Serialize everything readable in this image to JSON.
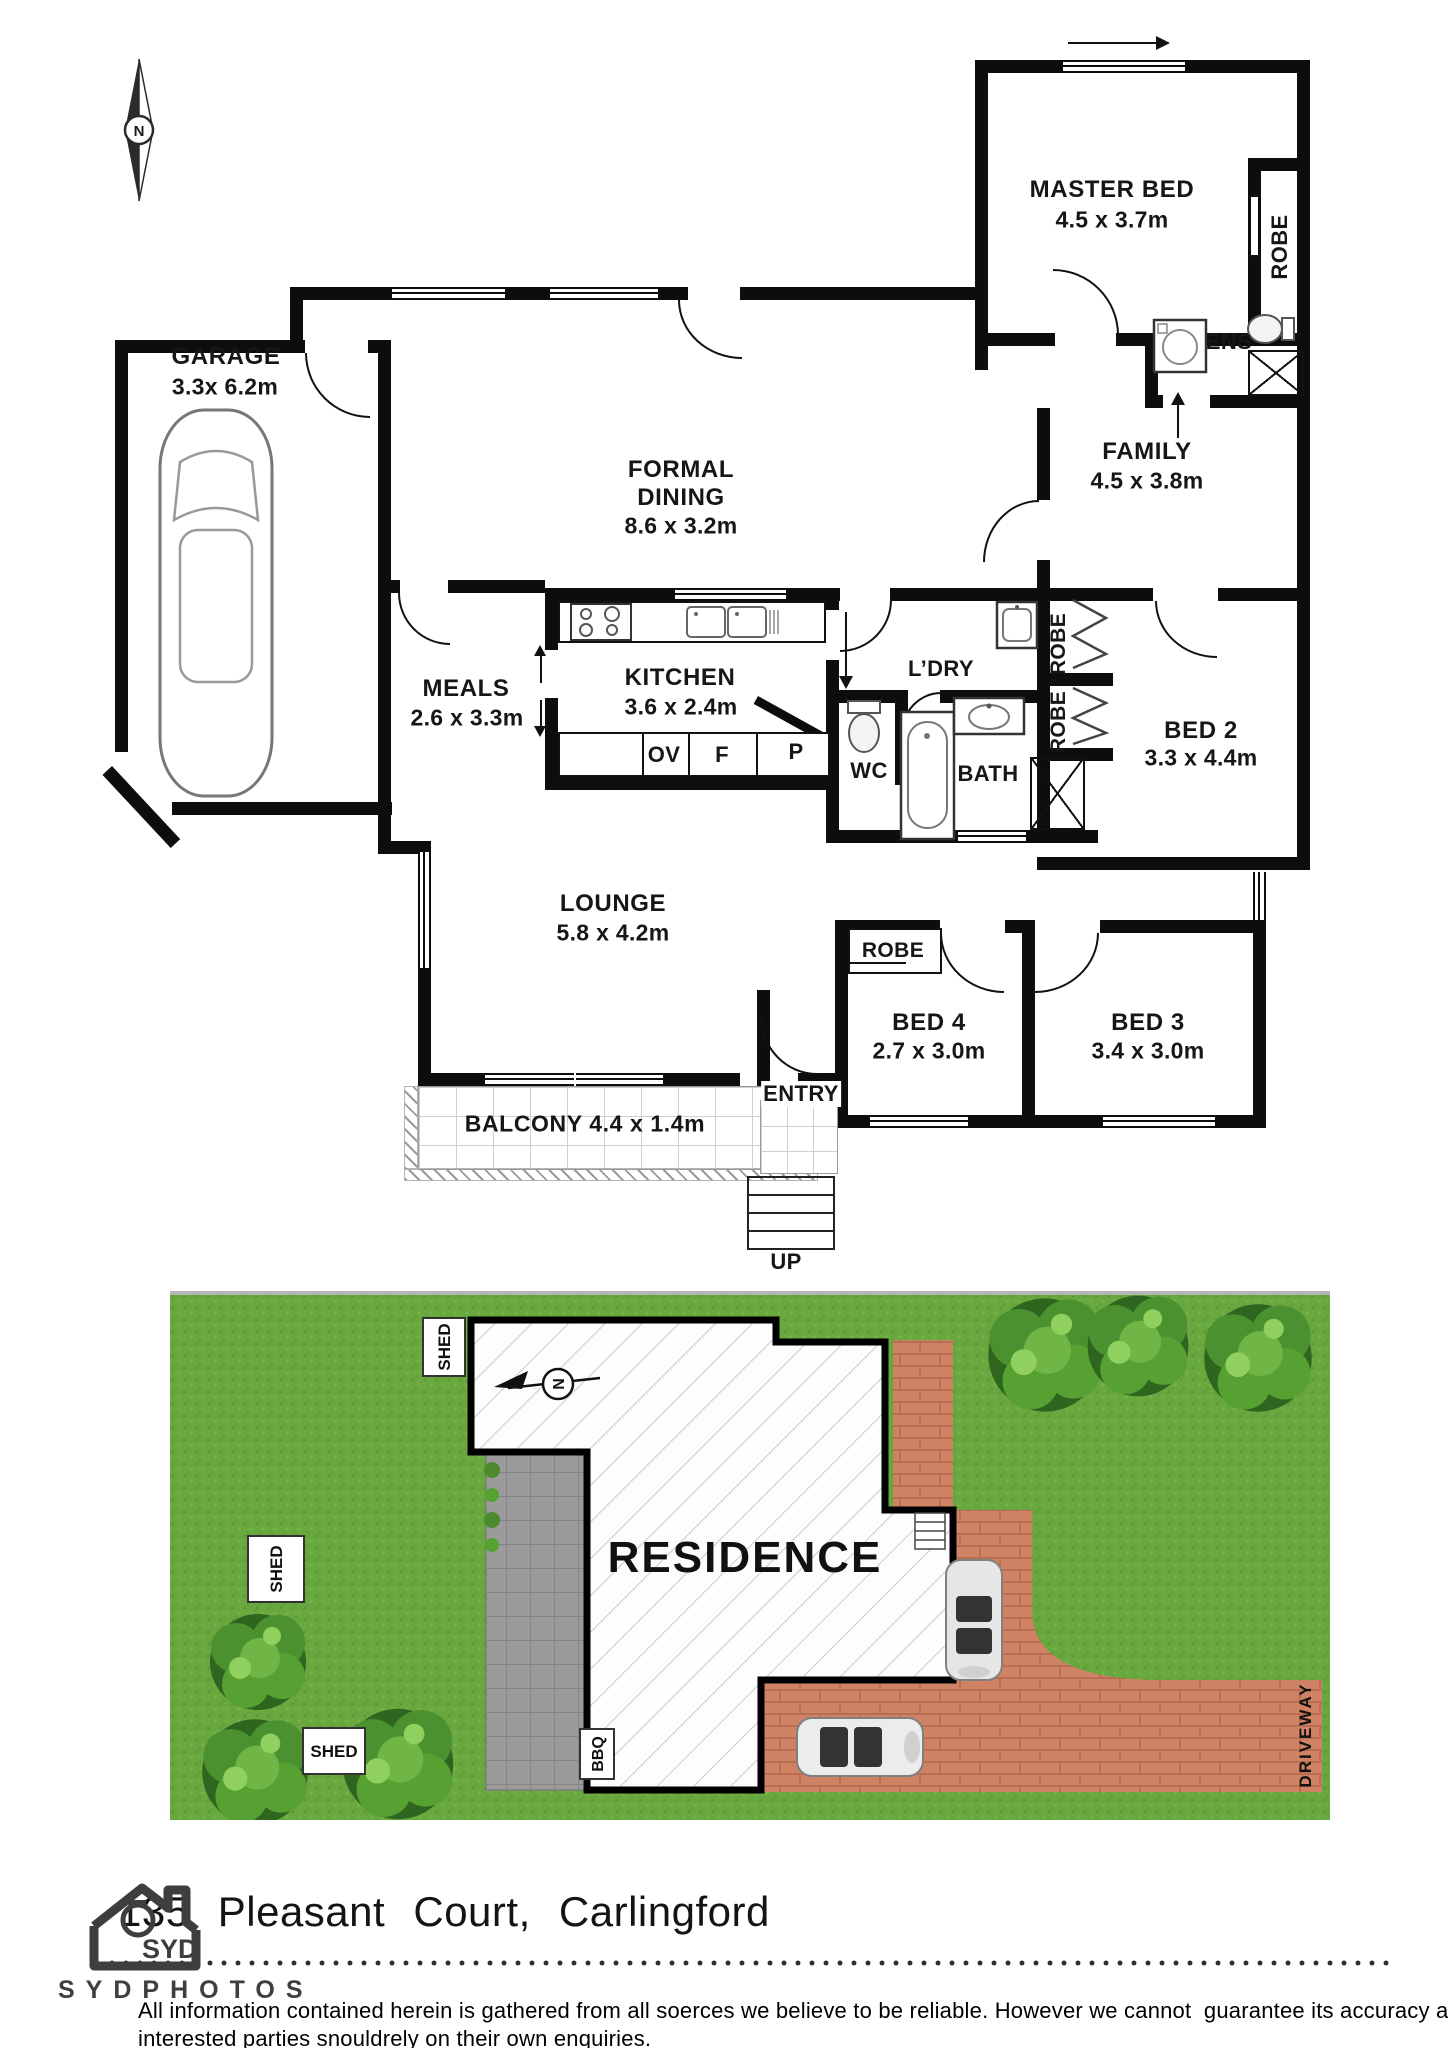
{
  "floorplan": {
    "compass": "N",
    "rooms": {
      "master_bed": {
        "name": "MASTER BED",
        "dims": "4.5 x 3.7m"
      },
      "family": {
        "name": "FAMILY",
        "dims": "4.5 x 3.8m"
      },
      "garage": {
        "name": "GARAGE",
        "dims": "3.3x 6.2m"
      },
      "formal_dining": {
        "line1": "FORMAL",
        "line2": "DINING",
        "dims": "8.6 x 3.2m"
      },
      "meals": {
        "name": "MEALS",
        "dims": "2.6 x 3.3m"
      },
      "kitchen": {
        "name": "KITCHEN",
        "dims": "3.6 x 2.4m"
      },
      "bed2": {
        "name": "BED 2",
        "dims": "3.3 x 4.4m"
      },
      "lounge": {
        "name": "LOUNGE",
        "dims": "5.8 x 4.2m"
      },
      "bed4": {
        "name": "BED 4",
        "dims": "2.7 x 3.0m"
      },
      "bed3": {
        "name": "BED 3",
        "dims": "3.4 x 3.0m"
      },
      "balcony": {
        "name": "BALCONY 4.4 x 1.4m"
      }
    },
    "labels": {
      "robe_master": "ROBE",
      "ens": "ENS",
      "ldry": "L’DRY",
      "wc": "WC",
      "bath": "BATH",
      "robe_upper": "ROBE",
      "robe_lower": "ROBE",
      "robe_bed4": "ROBE",
      "oven": "OV",
      "fridge": "F",
      "pantry": "P",
      "entry": "ENTRY",
      "up": "UP"
    }
  },
  "siteplan": {
    "residence": "RESIDENCE",
    "driveway": "DRIVEWAY",
    "bbq": "BBQ",
    "shed_top": "SHED",
    "shed_left": "SHED",
    "shed_bottom": "SHED",
    "compass": "N"
  },
  "footer": {
    "street_number": "135",
    "street_title": "Pleasant Court, Carlingford",
    "logo_text": "SYD",
    "brand": "SYDPHOTOS",
    "disclaimer_line1": "All information contained herein is gathered from all soerces we believe to be reliable. However we cannot  guarantee its accuracy and",
    "disclaimer_line2": "interested parties snouldrely on their own enquiries."
  },
  "colors": {
    "wall": "#0d0d0d",
    "grass": "#69a83f",
    "brick": "#d08264",
    "paving": "#999999"
  }
}
